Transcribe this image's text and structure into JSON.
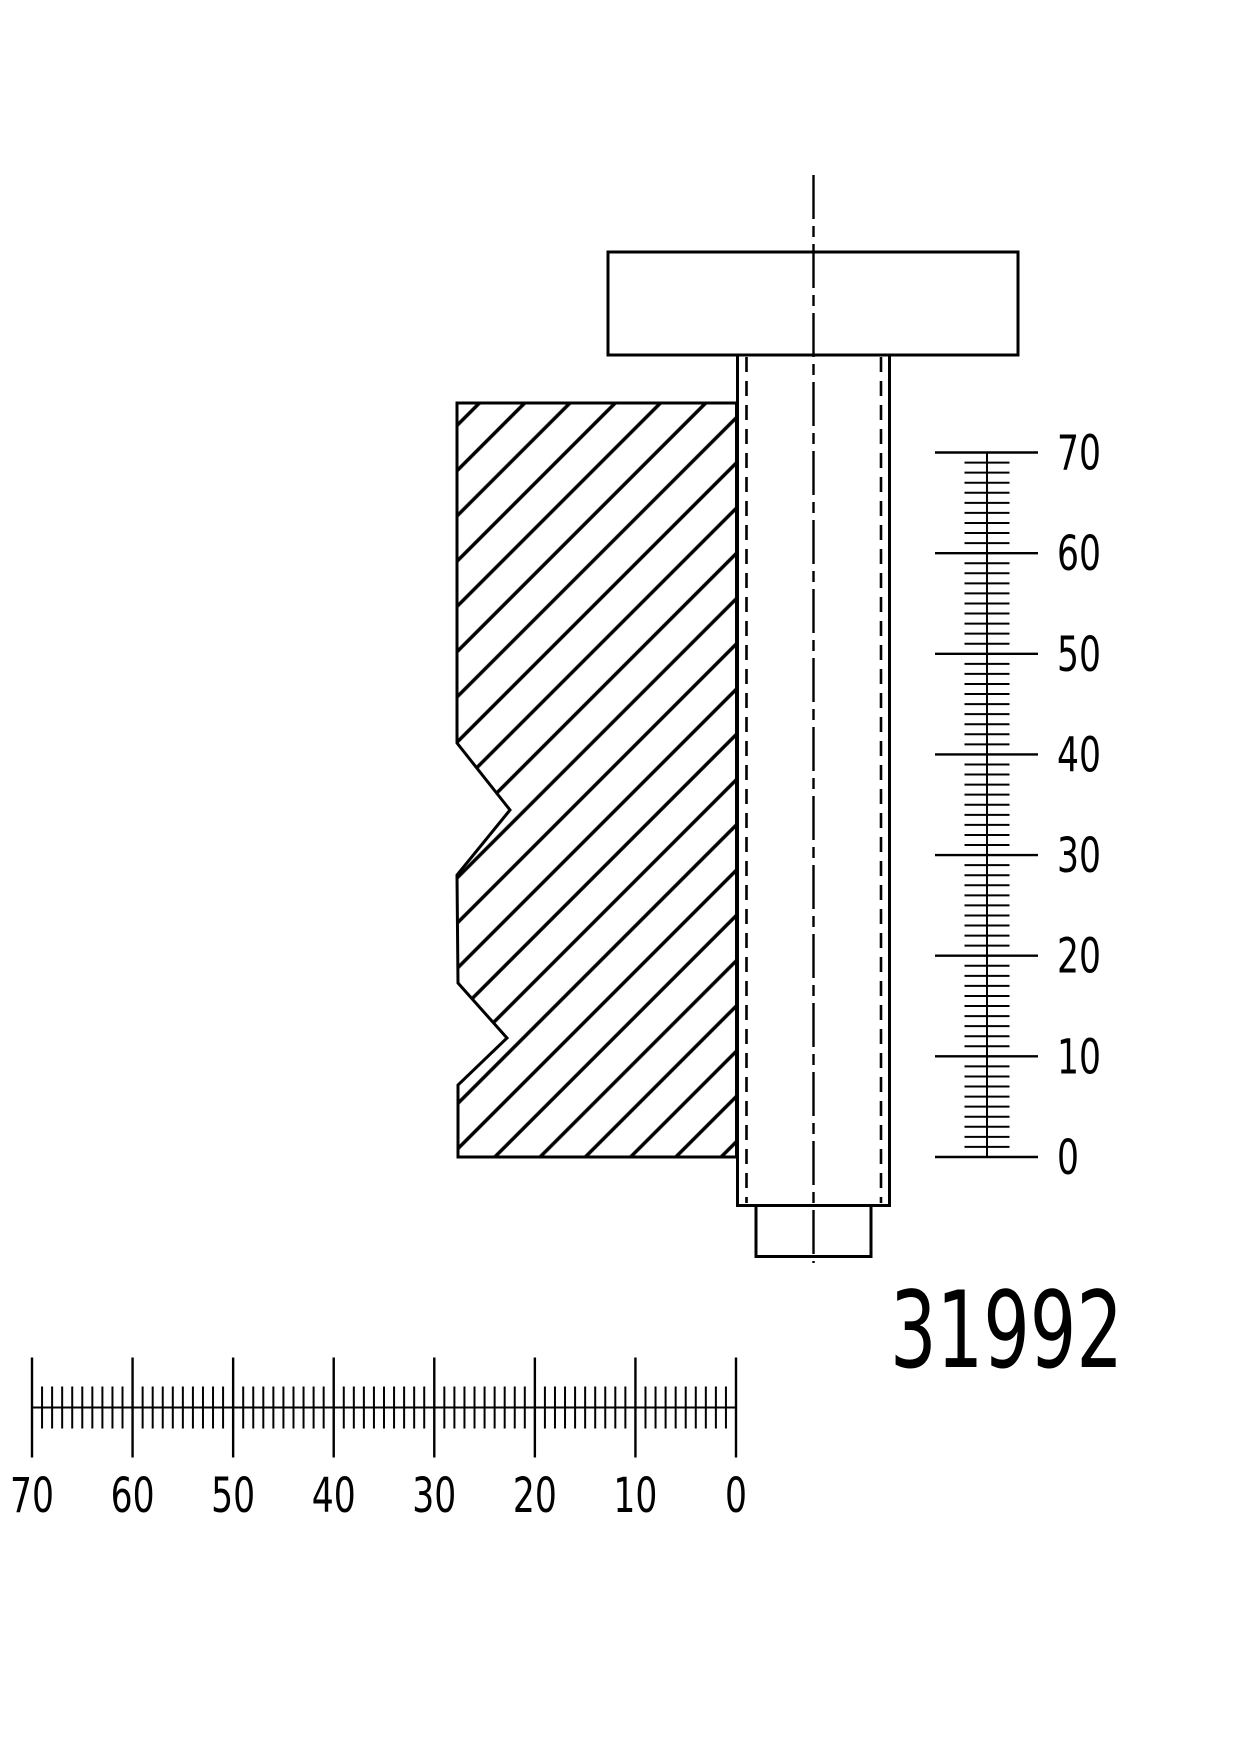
{
  "page": {
    "background_color": "#ffffff",
    "line_color": "#000000"
  },
  "drawing": {
    "type": "technical-cross-section",
    "part_number": "31992",
    "components": {
      "bolt_head": "screw head",
      "bolt_shank": "threaded shank with hidden thread lines",
      "clamped_block": "hatched sectioned block with two v-notches",
      "bolt_tip": "shank end stub",
      "centerline": "vertical dash-dot axis line"
    }
  },
  "vertical_ruler": {
    "unit_min": 0,
    "unit_max": 70,
    "major_step": 10,
    "minor_step": 1,
    "zero_position": "bottom",
    "labels": [
      "70",
      "60",
      "50",
      "40",
      "30",
      "20",
      "10",
      "0"
    ]
  },
  "horizontal_ruler": {
    "unit_min": 0,
    "unit_max": 70,
    "major_step": 10,
    "minor_step": 1,
    "zero_position": "right",
    "labels": [
      "70",
      "60",
      "50",
      "40",
      "30",
      "20",
      "10",
      "0"
    ]
  }
}
